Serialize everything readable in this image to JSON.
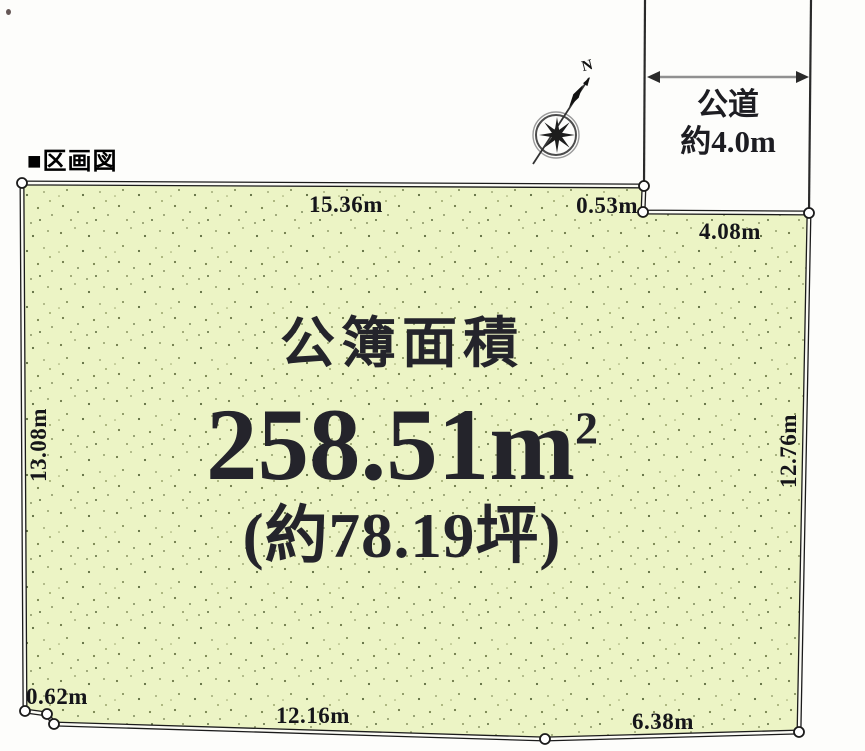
{
  "header": {
    "title": "■区画図"
  },
  "road": {
    "name": "公道",
    "width": "約4.0m"
  },
  "compass": {
    "north": "N"
  },
  "site": {
    "area_heading": "公簿面積",
    "area_value": "258.51m",
    "area_superscript": "2",
    "area_tsubo": "(約78.19坪)",
    "dimensions": {
      "top": "15.36m",
      "top_notch": "0.53m",
      "upper_right": "4.08m",
      "right_side": "12.76m",
      "left_side": "13.08m",
      "bottom_notch": "0.62m",
      "bottom": "12.16m",
      "bottom_right": "6.38m"
    }
  },
  "colors": {
    "land_fill": "#ecf4c5",
    "outline": "#1b1b1b",
    "label_text": "#15151a",
    "arrow_shaft": "#909090",
    "background": "#ffffff"
  }
}
